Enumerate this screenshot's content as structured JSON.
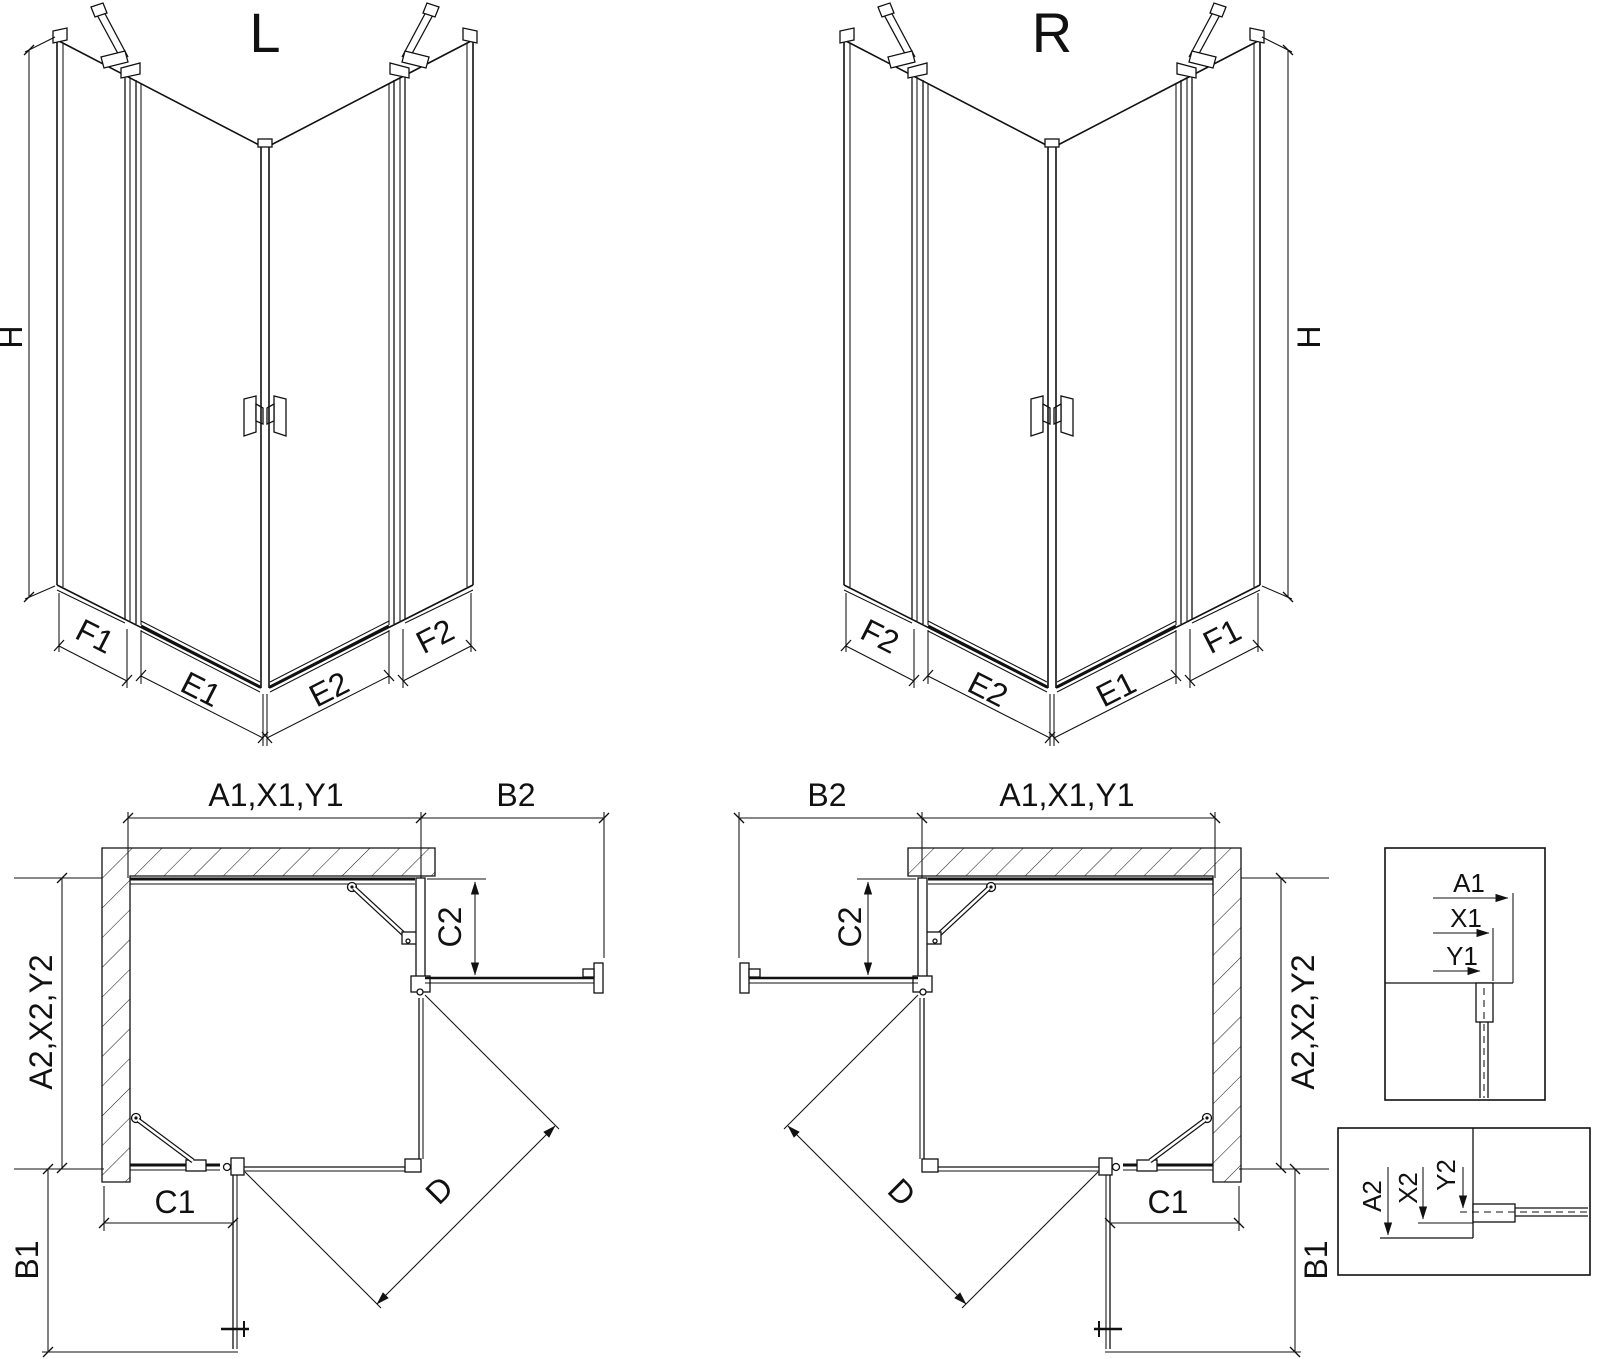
{
  "diagram": {
    "type": "technical-dimension-drawing",
    "subject": "corner-entry shower enclosure, left (L) and right (R) versions, isometric and plan views with profile details",
    "colors": {
      "line": "#111111",
      "hatch": "#222222",
      "background": "#ffffff"
    }
  },
  "iso_left": {
    "title": "L",
    "h": "H",
    "f1": "F1",
    "e1": "E1",
    "e2": "E2",
    "f2": "F2"
  },
  "iso_right": {
    "title": "R",
    "h": "H",
    "f1": "F1",
    "e1": "E1",
    "e2": "E2",
    "f2": "F2"
  },
  "plan_left": {
    "a1": "A1,X1,Y1",
    "b2": "B2",
    "c2": "C2",
    "a2": "A2,X2,Y2",
    "c1": "C1",
    "b1": "B1",
    "d": "D"
  },
  "plan_right": {
    "a1": "A1,X1,Y1",
    "b2": "B2",
    "c2": "C2",
    "a2": "A2,X2,Y2",
    "c1": "C1",
    "b1": "B1",
    "d": "D"
  },
  "detail_top": {
    "a1": "A1",
    "x1": "X1",
    "y1": "Y1"
  },
  "detail_bottom": {
    "a2": "A2",
    "x2": "X2",
    "y2": "Y2"
  }
}
